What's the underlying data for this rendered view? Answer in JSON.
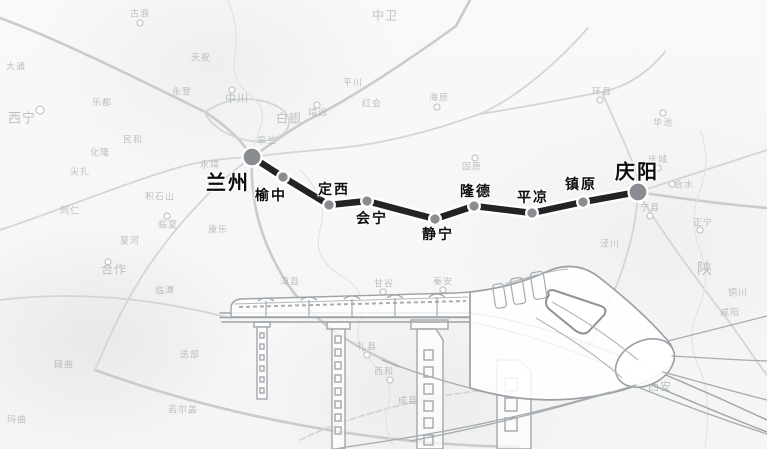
{
  "route": {
    "line_color": "#232323",
    "line_casing_color": "#ffffff",
    "line_width": 6.5,
    "dot_fill": "#898d91",
    "dot_ring": "#ffffff",
    "stations": [
      {
        "name": "兰州",
        "x": 252,
        "y": 157,
        "r": 9.5,
        "major": true,
        "lx": 228,
        "ly": 181,
        "fs": 20
      },
      {
        "name": "榆中",
        "x": 283,
        "y": 177,
        "r": 5.8,
        "major": false,
        "lx": 271,
        "ly": 195,
        "fs": 14
      },
      {
        "name": "定西",
        "x": 329,
        "y": 205,
        "r": 5.8,
        "major": false,
        "lx": 334,
        "ly": 189,
        "fs": 14
      },
      {
        "name": "会宁",
        "x": 367,
        "y": 201,
        "r": 5.8,
        "major": false,
        "lx": 372,
        "ly": 218,
        "fs": 14
      },
      {
        "name": "静宁",
        "x": 435,
        "y": 219,
        "r": 5.8,
        "major": false,
        "lx": 438,
        "ly": 234,
        "fs": 14
      },
      {
        "name": "隆德",
        "x": 474,
        "y": 206,
        "r": 5.8,
        "major": false,
        "lx": 476,
        "ly": 191,
        "fs": 14
      },
      {
        "name": "平凉",
        "x": 532,
        "y": 213,
        "r": 5.8,
        "major": false,
        "lx": 533,
        "ly": 197,
        "fs": 14
      },
      {
        "name": "镇原",
        "x": 583,
        "y": 202,
        "r": 5.8,
        "major": false,
        "lx": 581,
        "ly": 184,
        "fs": 14
      },
      {
        "name": "庆阳",
        "x": 638,
        "y": 192,
        "r": 9.5,
        "major": true,
        "lx": 637,
        "ly": 170,
        "fs": 20
      }
    ]
  },
  "background_labels": [
    {
      "t": "古浪",
      "x": 140,
      "y": 13
    },
    {
      "t": "天祝",
      "x": 201,
      "y": 57
    },
    {
      "t": "永登",
      "x": 182,
      "y": 91
    },
    {
      "t": "中川",
      "x": 237,
      "y": 98,
      "s": 11
    },
    {
      "t": "皋兰",
      "x": 267,
      "y": 140
    },
    {
      "t": "白银",
      "x": 289,
      "y": 118,
      "s": 12
    },
    {
      "t": "靖远",
      "x": 318,
      "y": 112
    },
    {
      "t": "平川",
      "x": 353,
      "y": 82
    },
    {
      "t": "红会",
      "x": 372,
      "y": 103
    },
    {
      "t": "海原",
      "x": 439,
      "y": 97
    },
    {
      "t": "中卫",
      "x": 385,
      "y": 15,
      "s": 12
    },
    {
      "t": "西宁",
      "x": 22,
      "y": 117,
      "s": 13
    },
    {
      "t": "大通",
      "x": 16,
      "y": 66
    },
    {
      "t": "乐都",
      "x": 102,
      "y": 102
    },
    {
      "t": "民和",
      "x": 133,
      "y": 139
    },
    {
      "t": "化隆",
      "x": 100,
      "y": 152
    },
    {
      "t": "尖扎",
      "x": 80,
      "y": 171
    },
    {
      "t": "同仁",
      "x": 70,
      "y": 210
    },
    {
      "t": "积石山",
      "x": 160,
      "y": 196
    },
    {
      "t": "临夏",
      "x": 168,
      "y": 224
    },
    {
      "t": "永靖",
      "x": 210,
      "y": 164
    },
    {
      "t": "康乐",
      "x": 218,
      "y": 229
    },
    {
      "t": "夏河",
      "x": 130,
      "y": 240
    },
    {
      "t": "合作",
      "x": 114,
      "y": 269,
      "s": 12
    },
    {
      "t": "临潭",
      "x": 165,
      "y": 290
    },
    {
      "t": "碌曲",
      "x": 64,
      "y": 364
    },
    {
      "t": "玛曲",
      "x": 17,
      "y": 419
    },
    {
      "t": "迭部",
      "x": 190,
      "y": 354
    },
    {
      "t": "若尔盖",
      "x": 183,
      "y": 409
    },
    {
      "t": "漳县",
      "x": 290,
      "y": 281
    },
    {
      "t": "甘谷",
      "x": 384,
      "y": 283
    },
    {
      "t": "秦安",
      "x": 443,
      "y": 281
    },
    {
      "t": "礼县",
      "x": 367,
      "y": 346
    },
    {
      "t": "西和",
      "x": 384,
      "y": 371
    },
    {
      "t": "成县",
      "x": 408,
      "y": 400
    },
    {
      "t": "固原",
      "x": 472,
      "y": 166
    },
    {
      "t": "环县",
      "x": 602,
      "y": 91
    },
    {
      "t": "华池",
      "x": 663,
      "y": 122
    },
    {
      "t": "庆城",
      "x": 658,
      "y": 159
    },
    {
      "t": "合水",
      "x": 684,
      "y": 184
    },
    {
      "t": "宁县",
      "x": 650,
      "y": 207
    },
    {
      "t": "正宁",
      "x": 703,
      "y": 222
    },
    {
      "t": "泾川",
      "x": 610,
      "y": 243
    },
    {
      "t": "陕",
      "x": 705,
      "y": 268,
      "s": 15
    },
    {
      "t": "铜川",
      "x": 738,
      "y": 292
    },
    {
      "t": "咸阳",
      "x": 730,
      "y": 312
    },
    {
      "t": "宝鸡",
      "x": 587,
      "y": 345
    },
    {
      "t": "西安",
      "x": 660,
      "y": 386,
      "s": 11
    }
  ]
}
